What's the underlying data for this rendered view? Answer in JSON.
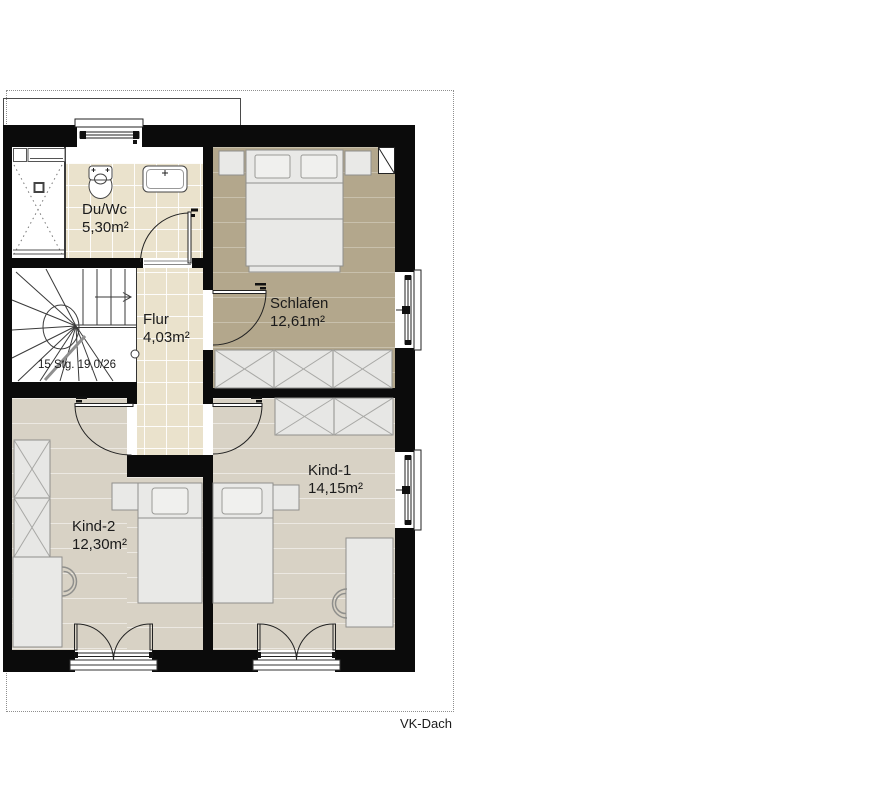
{
  "drawing": {
    "plan_label": "VK-Dach",
    "stairs_note": "15 Stg. 19,0/26"
  },
  "rooms": {
    "duwc": {
      "name": "Du/Wc",
      "area": "5,30m²"
    },
    "schlafen": {
      "name": "Schlafen",
      "area": "12,61m²"
    },
    "flur": {
      "name": "Flur",
      "area": "4,03m²"
    },
    "kind1": {
      "name": "Kind-1",
      "area": "14,15m²"
    },
    "kind2": {
      "name": "Kind-2",
      "area": "12,30m²"
    }
  },
  "colors": {
    "wall": "#0b0b0b",
    "tile_floor": "#eae2cc",
    "bedroom_floor": "#b3a78c",
    "kids_floor": "#d8d2c5",
    "furniture": "#e9e9e7",
    "boundary_dash": "#8f8f8f"
  }
}
